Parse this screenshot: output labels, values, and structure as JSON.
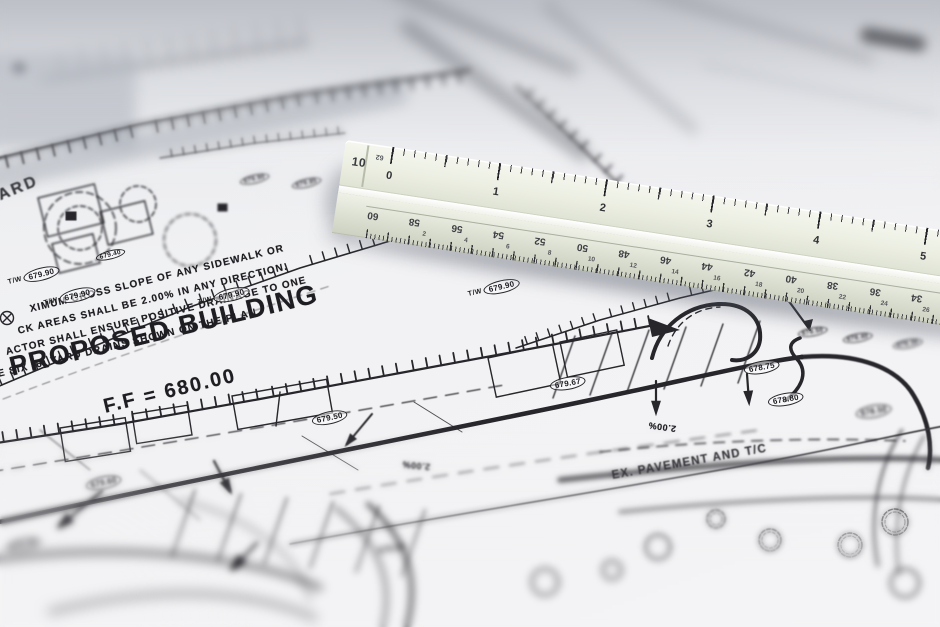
{
  "plan": {
    "yard_label": "YARD",
    "notes": [
      "XIMUM CROSS SLOPE OF ANY SIDEWALK OR",
      "CK AREAS SHALL BE 2.00% IN ANY DIRECTION.",
      "ACTOR SHALL ENSURE POSITIVE DRAINAGE TO ONE",
      "E SIX (6) YARD DRAINS SHOWN ON THE PLAN."
    ],
    "building_label": "PROPOSED BUILDING",
    "ff_label": "F.F = 680.00",
    "slope_label": "2.00%",
    "pavement_label": "EX. PAVEMENT AND T/C",
    "faint_label": "679.50",
    "markers": [
      {
        "prefix": "T/W",
        "label": "679.90"
      },
      {
        "prefix": "T/W",
        "label": "679.90"
      },
      {
        "prefix": "T/W",
        "label": "679.90"
      },
      {
        "prefix": "T/W",
        "label": "679.90"
      },
      {
        "prefix": "",
        "label": "679.40"
      },
      {
        "prefix": "",
        "label": "679.50"
      },
      {
        "prefix": "",
        "label": "679.67"
      },
      {
        "prefix": "",
        "label": "678.75"
      },
      {
        "prefix": "",
        "label": "678.80"
      },
      {
        "prefix": "",
        "label": "679.60"
      },
      {
        "prefix": "",
        "label": "678.00"
      },
      {
        "prefix": "",
        "label": "678.50"
      },
      {
        "prefix": "",
        "label": "679.90"
      },
      {
        "prefix": "",
        "label": "679.85"
      },
      {
        "prefix": "",
        "label": "678.50"
      },
      {
        "prefix": "",
        "label": "678.40"
      },
      {
        "prefix": "",
        "label": "678.30"
      }
    ]
  },
  "ruler": {
    "scale_label": "10",
    "tip_number": "62",
    "top_numbers": [
      "0",
      "1",
      "2",
      "3",
      "4",
      "5"
    ],
    "front_numbers_large": [
      "60",
      "58",
      "56",
      "54",
      "52",
      "50",
      "48",
      "46",
      "44",
      "42",
      "40",
      "38",
      "36",
      "34"
    ],
    "front_numbers_small": [
      "",
      "2",
      "4",
      "6",
      "8",
      "10",
      "12",
      "14",
      "16",
      "18",
      "20",
      "22",
      "24",
      "26"
    ]
  }
}
